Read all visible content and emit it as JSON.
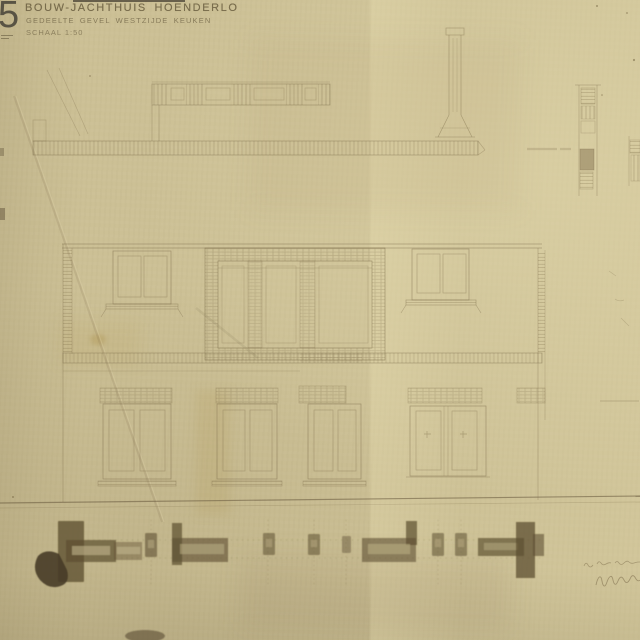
{
  "title_block": {
    "sheet_number": "5",
    "title": "BOUW-JACHTHUIS HOENDERLO",
    "subtitle": "GEDEELTE GEVEL WESTZIJDE KEUKEN",
    "scale": "SCHAAL 1:50"
  },
  "annotations": {
    "right_margin_label": "illegible faint pencil label",
    "right_edge_note": "illegible faint pencil note",
    "bottom_right_handwriting": "illegible pencil date and signature"
  },
  "colors": {
    "paper": "#ccc095",
    "paper_light": "#d5caa2",
    "paper_dark": "#c3b78a",
    "pencil": "#7a6a48",
    "ink": "#5d4f30",
    "ink_blot": "#443a25",
    "title_text": "#685c3e",
    "sheet_number_text": "#474338"
  }
}
